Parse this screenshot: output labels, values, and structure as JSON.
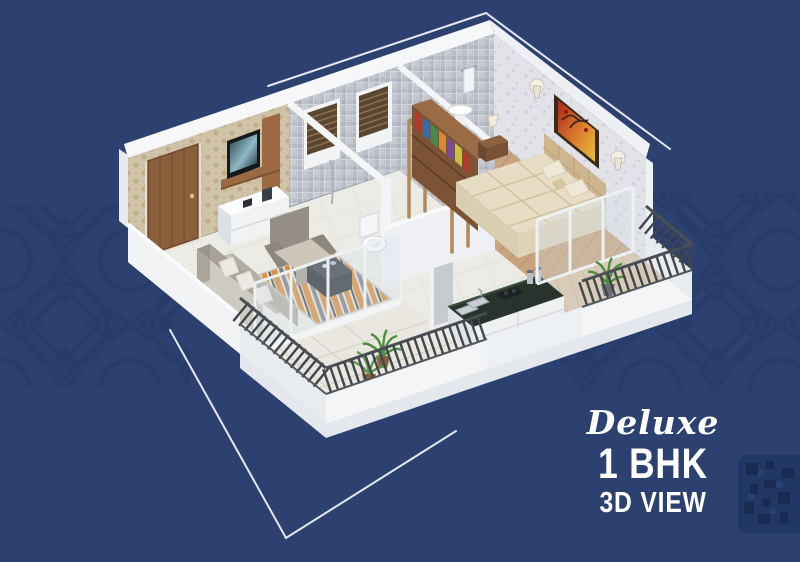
{
  "badge": {
    "script": "Deluxe",
    "line1": "1 BHK",
    "line2": "3D VIEW"
  },
  "palette": {
    "background": "#2c4170",
    "pattern": "#1b2f58",
    "text": "#ffffff",
    "wall_white": "#f3f4f6",
    "wood_accent": "#8a5f3c",
    "rug_orange": "#d98f3f",
    "counter_dark": "#27332c",
    "railing_dark": "#41464d",
    "plant_green": "#4c8f3f"
  }
}
